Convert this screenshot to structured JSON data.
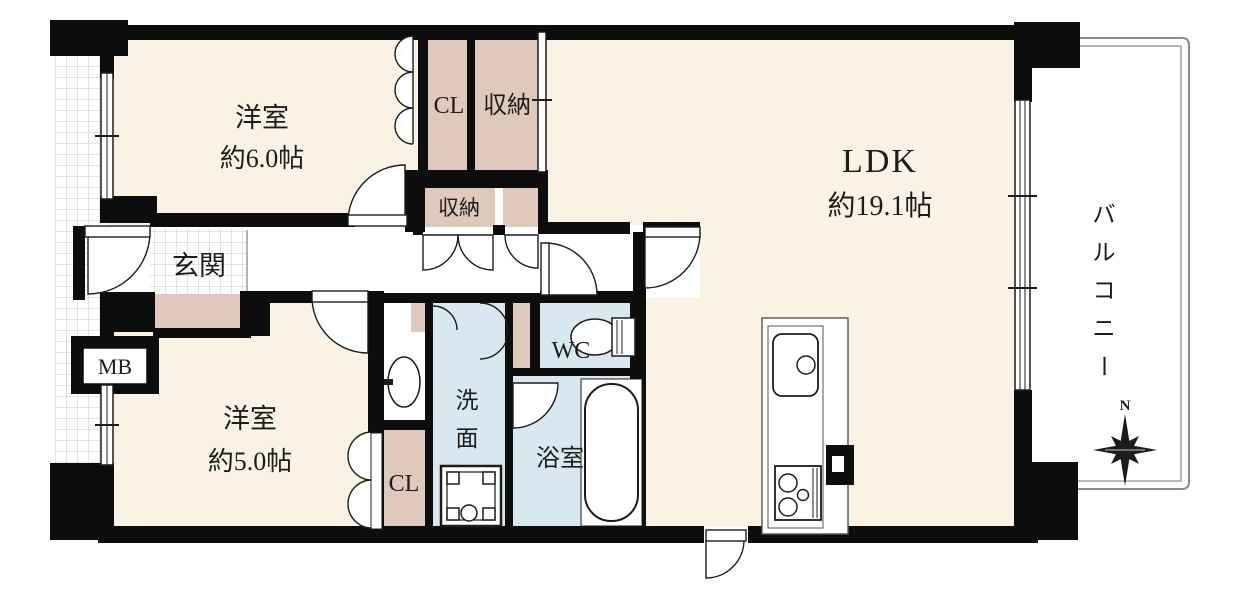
{
  "plan": {
    "type": "apartment-floor-plan",
    "rooms": {
      "bedroom1": {
        "name": "洋室",
        "size": "約6.0帖"
      },
      "bedroom2": {
        "name": "洋室",
        "size": "約5.0帖"
      },
      "ldk": {
        "name": "LDK",
        "size": "約19.1帖"
      },
      "entrance": {
        "name": "玄関"
      },
      "meter_box": {
        "name": "MB"
      },
      "closet_top": {
        "name": "CL"
      },
      "storage_top": {
        "name": "収納"
      },
      "storage_hall": {
        "name": "収納"
      },
      "closet_bottom": {
        "name": "CL"
      },
      "washroom": {
        "name": "洗面",
        "char1": "洗",
        "char2": "面"
      },
      "bathroom": {
        "name": "浴室"
      },
      "toilet": {
        "name": "WC"
      },
      "balcony": {
        "name": "バルコニー",
        "char1": "バ",
        "char2": "ル",
        "char3": "コ",
        "char4": "ニ",
        "char5": "ー"
      }
    },
    "compass": {
      "north": "N"
    },
    "colors": {
      "room_fill": "#faf3e5",
      "closet_fill": "#dfc8bc",
      "wet_fill": "#d9e8f0",
      "wall": "#0d0d0d",
      "balcony_line": "#8a8a8a",
      "tile_line": "#c9c9c9"
    }
  }
}
